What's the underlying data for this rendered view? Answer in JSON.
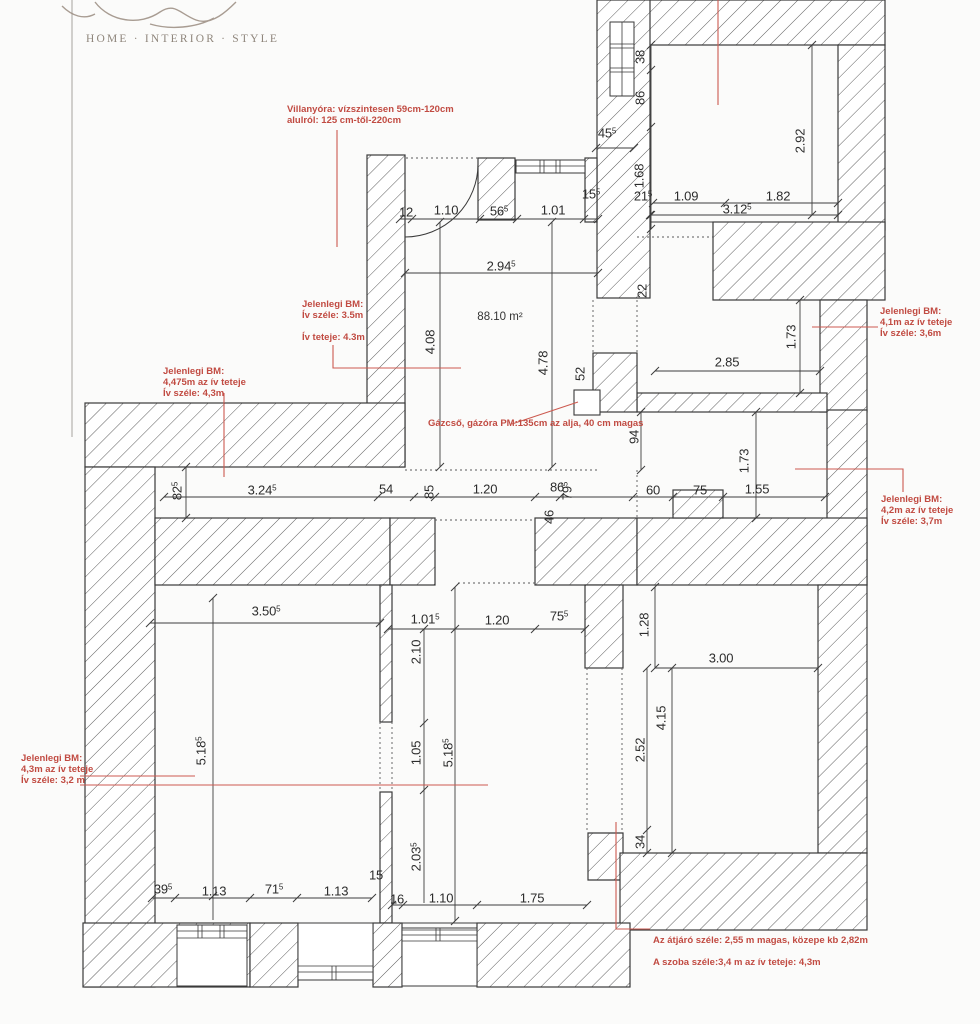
{
  "logo": {
    "tagline": "HOME · INTERIOR · STYLE"
  },
  "plan": {
    "area_label": "88.10 m²",
    "colors": {
      "annotation_red": "#c14b42",
      "red_line": "#cc5a50",
      "wall_line": "#3a3a3a",
      "dim_text": "#2c2c2c",
      "logo_gray": "#8f867c"
    },
    "dimension_labels": [
      {
        "text": "45^5",
        "x": 607,
        "y": 133,
        "rot": 0
      },
      {
        "text": "38",
        "x": 640,
        "y": 57,
        "rot": 90
      },
      {
        "text": "86",
        "x": 640,
        "y": 98,
        "rot": 90
      },
      {
        "text": "2.92",
        "x": 800,
        "y": 141,
        "rot": 90
      },
      {
        "text": "1.68",
        "x": 639,
        "y": 176,
        "rot": 90
      },
      {
        "text": "21^5",
        "x": 643,
        "y": 196,
        "rot": 0
      },
      {
        "text": "1.09",
        "x": 686,
        "y": 196,
        "rot": 0
      },
      {
        "text": "1.82",
        "x": 778,
        "y": 196,
        "rot": 0
      },
      {
        "text": "3.12^5",
        "x": 737,
        "y": 209,
        "rot": 0
      },
      {
        "text": "12",
        "x": 406,
        "y": 212,
        "rot": 0
      },
      {
        "text": "1.10",
        "x": 446,
        "y": 210,
        "rot": 0
      },
      {
        "text": "56^5",
        "x": 499,
        "y": 211,
        "rot": 0
      },
      {
        "text": "1.01",
        "x": 553,
        "y": 210,
        "rot": 0
      },
      {
        "text": "15^5",
        "x": 591,
        "y": 194,
        "rot": 0
      },
      {
        "text": "2.94^5",
        "x": 501,
        "y": 266,
        "rot": 0
      },
      {
        "text": "4.08",
        "x": 430,
        "y": 342,
        "rot": 90
      },
      {
        "text": "4.78",
        "x": 543,
        "y": 363,
        "rot": 90
      },
      {
        "text": "52",
        "x": 580,
        "y": 374,
        "rot": 90
      },
      {
        "text": "22",
        "x": 642,
        "y": 291,
        "rot": 90
      },
      {
        "text": "2.85",
        "x": 727,
        "y": 362,
        "rot": 0
      },
      {
        "text": "1.73",
        "x": 791,
        "y": 337,
        "rot": 90
      },
      {
        "text": "94",
        "x": 634,
        "y": 437,
        "rot": 90
      },
      {
        "text": "82^5",
        "x": 177,
        "y": 491,
        "rot": 90
      },
      {
        "text": "3.24^5",
        "x": 262,
        "y": 490,
        "rot": 0
      },
      {
        "text": "54",
        "x": 386,
        "y": 489,
        "rot": 0
      },
      {
        "text": "85",
        "x": 429,
        "y": 492,
        "rot": 90
      },
      {
        "text": "1.20",
        "x": 485,
        "y": 489,
        "rot": 0
      },
      {
        "text": "86",
        "x": 557,
        "y": 487,
        "rot": 0
      },
      {
        "text": "79^5",
        "x": 567,
        "y": 491,
        "rot": 90
      },
      {
        "text": "46",
        "x": 549,
        "y": 517,
        "rot": 90
      },
      {
        "text": "60",
        "x": 653,
        "y": 490,
        "rot": 0
      },
      {
        "text": "75",
        "x": 700,
        "y": 490,
        "rot": 0
      },
      {
        "text": "1.55",
        "x": 757,
        "y": 489,
        "rot": 0
      },
      {
        "text": "1.73",
        "x": 744,
        "y": 461,
        "rot": 90
      },
      {
        "text": "3.50^5",
        "x": 266,
        "y": 611,
        "rot": 0
      },
      {
        "text": "1.01^5",
        "x": 425,
        "y": 619,
        "rot": 0
      },
      {
        "text": "1.20",
        "x": 497,
        "y": 620,
        "rot": 0
      },
      {
        "text": "75^5",
        "x": 559,
        "y": 616,
        "rot": 0
      },
      {
        "text": "2.10",
        "x": 416,
        "y": 652,
        "rot": 90
      },
      {
        "text": "1.05",
        "x": 416,
        "y": 753,
        "rot": 90
      },
      {
        "text": "5.18^5",
        "x": 448,
        "y": 753,
        "rot": 90
      },
      {
        "text": "2.03^5",
        "x": 416,
        "y": 857,
        "rot": 90
      },
      {
        "text": "5.18^5",
        "x": 201,
        "y": 751,
        "rot": 90
      },
      {
        "text": "1.28",
        "x": 644,
        "y": 625,
        "rot": 90
      },
      {
        "text": "3.00",
        "x": 721,
        "y": 658,
        "rot": 0
      },
      {
        "text": "4.15",
        "x": 661,
        "y": 718,
        "rot": 90
      },
      {
        "text": "2.52",
        "x": 640,
        "y": 750,
        "rot": 90
      },
      {
        "text": "34",
        "x": 640,
        "y": 842,
        "rot": 90
      },
      {
        "text": "39^5",
        "x": 163,
        "y": 889,
        "rot": 0
      },
      {
        "text": "1.13",
        "x": 214,
        "y": 891,
        "rot": 0
      },
      {
        "text": "71^5",
        "x": 274,
        "y": 889,
        "rot": 0
      },
      {
        "text": "1.13",
        "x": 336,
        "y": 891,
        "rot": 0
      },
      {
        "text": "15",
        "x": 376,
        "y": 875,
        "rot": 0
      },
      {
        "text": "16",
        "x": 397,
        "y": 899,
        "rot": 0
      },
      {
        "text": "1.10",
        "x": 441,
        "y": 898,
        "rot": 0
      },
      {
        "text": "1.75",
        "x": 532,
        "y": 898,
        "rot": 0
      }
    ],
    "annotations": [
      {
        "id": "villanyora",
        "x": 287,
        "y": 104,
        "lines": [
          "Villanyóra: vízszintesen 59cm-120cm",
          "alulról: 125 cm-től-220cm"
        ]
      },
      {
        "id": "bm-central",
        "x": 302,
        "y": 299,
        "lines": [
          "Jelenlegi BM:",
          "Ív széle: 3.5m",
          "",
          "Ív teteje: 4.3m"
        ]
      },
      {
        "id": "bm-left",
        "x": 163,
        "y": 366,
        "lines": [
          "Jelenlegi BM:",
          "4,475m az ív teteje",
          "Ív széle: 4,3m"
        ]
      },
      {
        "id": "gazcso",
        "x": 428,
        "y": 418,
        "lines": [
          "Gázcső, gázóra PM:135cm az alja, 40 cm magas"
        ]
      },
      {
        "id": "bm-right-upper",
        "x": 880,
        "y": 306,
        "lines": [
          "Jelenlegi BM:",
          "4,1m az ív teteje",
          "Ív széle: 3,6m"
        ]
      },
      {
        "id": "bm-right-lower",
        "x": 881,
        "y": 494,
        "lines": [
          "Jelenlegi BM:",
          "4,2m az ív teteje",
          "Ív széle: 3,7m"
        ]
      },
      {
        "id": "bm-bottom-left",
        "x": 21,
        "y": 753,
        "lines": [
          "Jelenlegi BM:",
          "4,3m az ív teteje",
          "Ív széle: 3,2 m"
        ]
      },
      {
        "id": "atjaro",
        "x": 653,
        "y": 935,
        "lines": [
          "Az átjáró széle: 2,55 m magas, közepe kb 2,82m",
          "",
          "A szoba széle:3,4 m az ív teteje: 4,3m"
        ]
      }
    ]
  }
}
